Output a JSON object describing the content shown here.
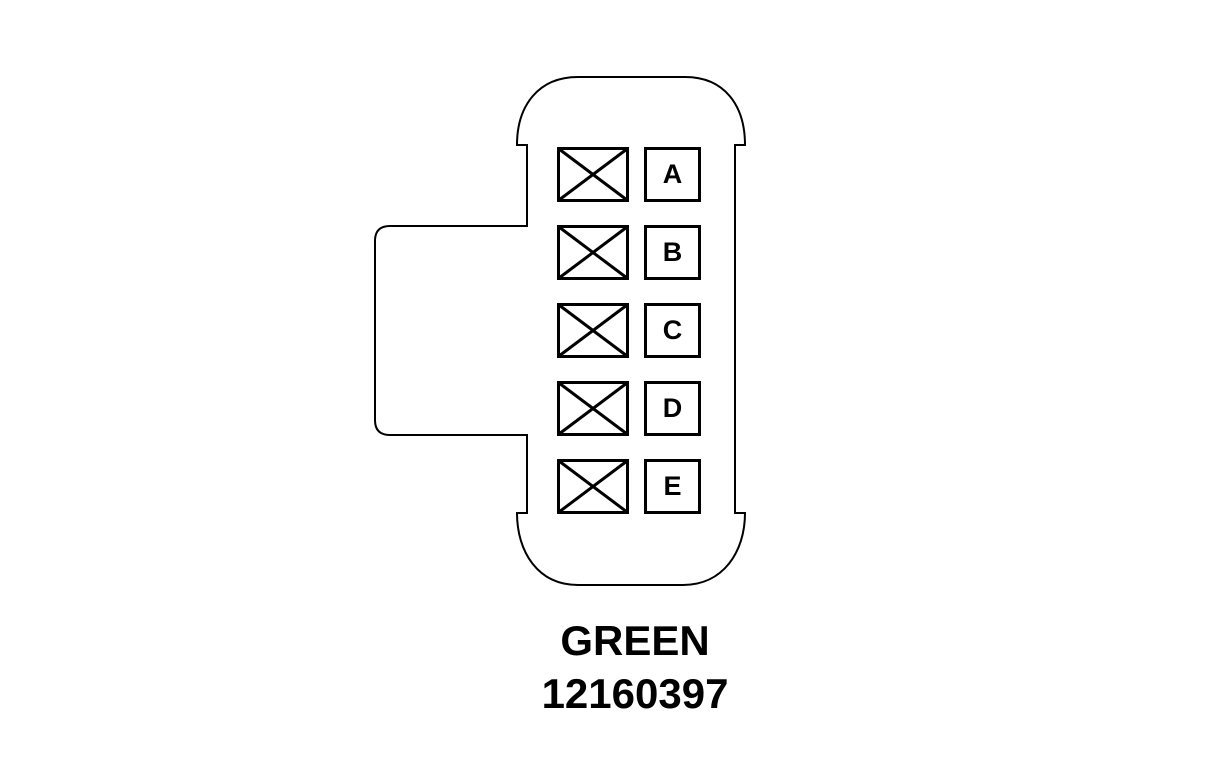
{
  "diagram": {
    "type": "connector-pinout",
    "connector_color_label": "GREEN",
    "part_number": "12160397",
    "pins": [
      {
        "label": "A",
        "blocked_cavity_beside": true
      },
      {
        "label": "B",
        "blocked_cavity_beside": true
      },
      {
        "label": "C",
        "blocked_cavity_beside": true
      },
      {
        "label": "D",
        "blocked_cavity_beside": true
      },
      {
        "label": "E",
        "blocked_cavity_beside": true
      }
    ],
    "colors": {
      "line": "#000000",
      "background": "#ffffff"
    }
  }
}
